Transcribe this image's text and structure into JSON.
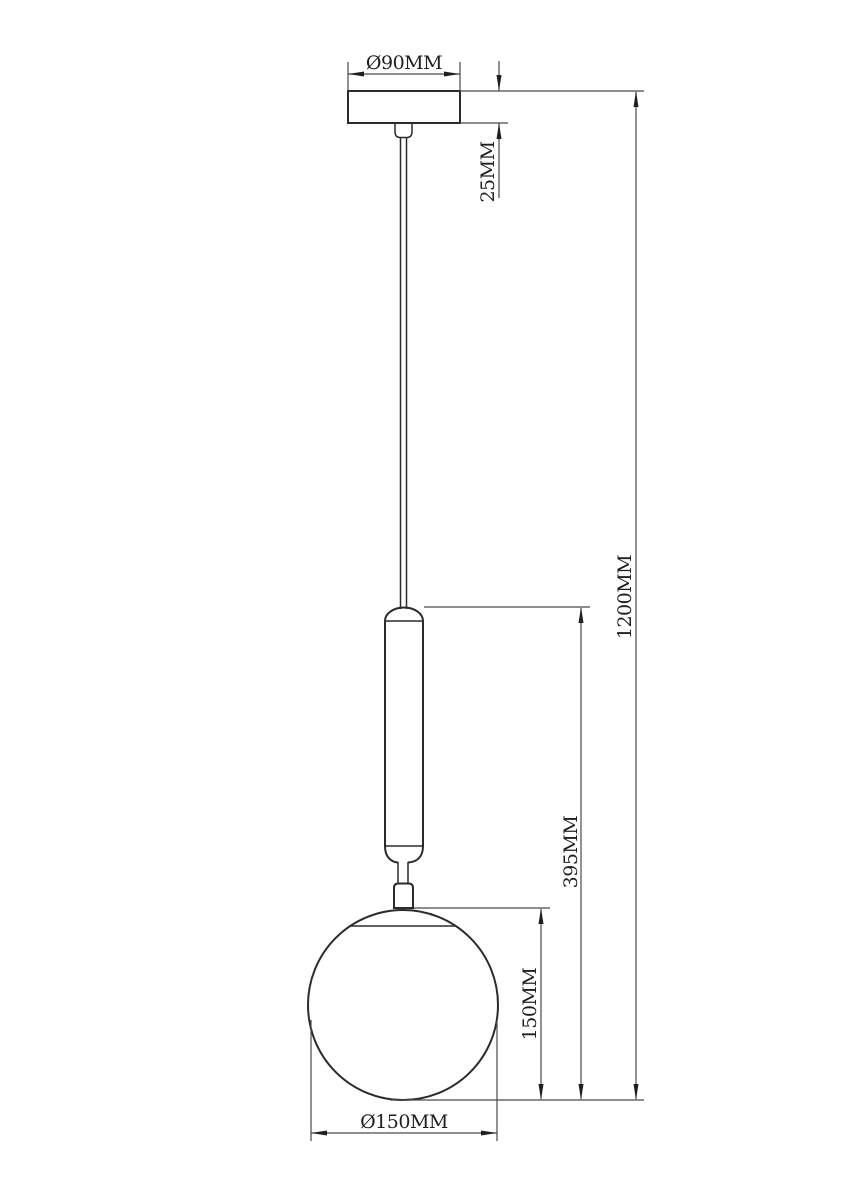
{
  "drawing": {
    "labels": {
      "canopy_diameter": "Ø90MM",
      "canopy_height": "25MM",
      "overall_height": "1200MM",
      "body_drop": "395MM",
      "globe_height": "150MM",
      "globe_diameter": "Ø150MM"
    },
    "colors": {
      "outline": "#2b2b2b",
      "dimension_line": "#4a4a4a",
      "text": "#1f1f1f",
      "background": "#ffffff"
    }
  }
}
